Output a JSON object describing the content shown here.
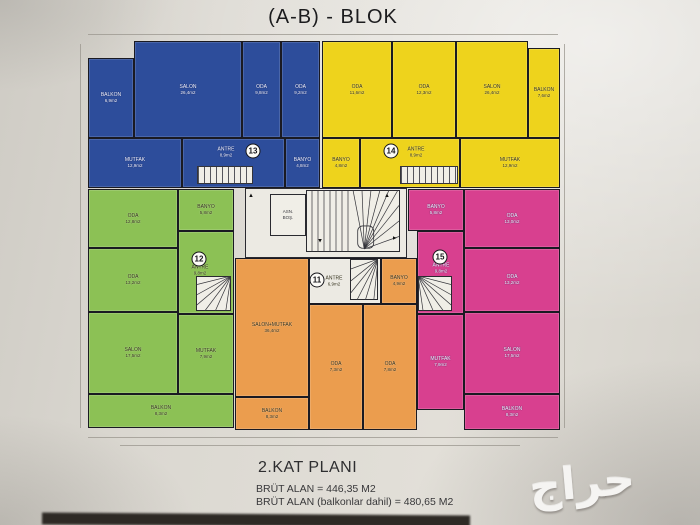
{
  "title": "(A-B) - BLOK",
  "footer": {
    "plan_name": "2.KAT PLANI",
    "line1": "BRÜT ALAN = 446,35 M2",
    "line2": "BRÜT ALAN (balkonlar dahil) = 480,65 M2"
  },
  "watermark": "حراج",
  "plan": {
    "elevator_label_line1": "ASN.",
    "elevator_label_line2": "BOŞ.",
    "colors": {
      "blue": "#2d4d9b",
      "yellow": "#eed31c",
      "green": "#8cc155",
      "orange": "#eb9d4e",
      "pink": "#d8408f",
      "white": "#eceae3"
    },
    "apartments": [
      {
        "number": "13",
        "color": "blue",
        "light": true,
        "circle": {
          "x": 253,
          "y": 151
        },
        "rooms": [
          {
            "key": "balkon",
            "label": "BALKON",
            "area": "6,9m2",
            "x": 88,
            "y": 58,
            "w": 44,
            "h": 78
          },
          {
            "key": "salon",
            "label": "SALON",
            "area": "26,4m2",
            "x": 134,
            "y": 41,
            "w": 106,
            "h": 95
          },
          {
            "key": "oda-1",
            "label": "ODA",
            "area": "9,8m2",
            "x": 242,
            "y": 41,
            "w": 37,
            "h": 95
          },
          {
            "key": "oda-2",
            "label": "ODA",
            "area": "9,2m2",
            "x": 281,
            "y": 41,
            "w": 37,
            "h": 95
          },
          {
            "key": "mutfak",
            "label": "MUTFAK",
            "area": "12,9m2",
            "x": 88,
            "y": 138,
            "w": 92,
            "h": 48
          },
          {
            "key": "antre",
            "label": "ANTRE",
            "area": "8,9m2",
            "x": 182,
            "y": 138,
            "w": 101,
            "h": 48,
            "lx": 226,
            "ly": 152
          },
          {
            "key": "banyo",
            "label": "BANYO",
            "area": "4,8m2",
            "x": 285,
            "y": 138,
            "w": 33,
            "h": 48
          }
        ]
      },
      {
        "number": "14",
        "color": "yellow",
        "light": false,
        "circle": {
          "x": 391,
          "y": 151
        },
        "rooms": [
          {
            "key": "oda-1",
            "label": "ODA",
            "area": "11,6m2",
            "x": 322,
            "y": 41,
            "w": 68,
            "h": 95
          },
          {
            "key": "oda-2",
            "label": "ODA",
            "area": "12,3m2",
            "x": 392,
            "y": 41,
            "w": 62,
            "h": 95
          },
          {
            "key": "salon",
            "label": "SALON",
            "area": "26,4m2",
            "x": 456,
            "y": 41,
            "w": 70,
            "h": 95
          },
          {
            "key": "balkon",
            "label": "BALKON",
            "area": "7,6m2",
            "x": 528,
            "y": 48,
            "w": 30,
            "h": 88
          },
          {
            "key": "banyo",
            "label": "BANYO",
            "area": "4,8m2",
            "x": 322,
            "y": 138,
            "w": 36,
            "h": 48
          },
          {
            "key": "antre",
            "label": "ANTRE",
            "area": "8,9m2",
            "x": 360,
            "y": 138,
            "w": 98,
            "h": 48,
            "lx": 416,
            "ly": 152
          },
          {
            "key": "mutfak",
            "label": "MUTFAK",
            "area": "12,9m2",
            "x": 460,
            "y": 138,
            "w": 98,
            "h": 48
          }
        ]
      },
      {
        "number": "12",
        "color": "green",
        "light": false,
        "circle": {
          "x": 199,
          "y": 259
        },
        "rooms": [
          {
            "key": "oda-1",
            "label": "ODA",
            "area": "12,8m2",
            "x": 88,
            "y": 189,
            "w": 88,
            "h": 57
          },
          {
            "key": "oda-2",
            "label": "ODA",
            "area": "13,2m2",
            "x": 88,
            "y": 248,
            "w": 88,
            "h": 62
          },
          {
            "key": "salon",
            "label": "SALON",
            "area": "17,5m2",
            "x": 88,
            "y": 312,
            "w": 88,
            "h": 80
          },
          {
            "key": "balkon",
            "label": "BALKON",
            "area": "8,3m2",
            "x": 88,
            "y": 394,
            "w": 144,
            "h": 32
          },
          {
            "key": "banyo",
            "label": "BANYO",
            "area": "5,8m2",
            "x": 178,
            "y": 189,
            "w": 54,
            "h": 40
          },
          {
            "key": "antre",
            "label": "ANTRE",
            "area": "9,8m2",
            "x": 178,
            "y": 231,
            "w": 54,
            "h": 81,
            "lx": 200,
            "ly": 270
          },
          {
            "key": "mutfak",
            "label": "MUTFAK",
            "area": "7,9m2",
            "x": 178,
            "y": 314,
            "w": 54,
            "h": 78
          }
        ]
      },
      {
        "number": "11",
        "color": "orange",
        "light": false,
        "circle": {
          "x": 317,
          "y": 280
        },
        "rooms": [
          {
            "key": "salon-mutfak",
            "label": "SALON+MUTFAK",
            "area": "36,4m2",
            "x": 235,
            "y": 258,
            "w": 72,
            "h": 137
          },
          {
            "key": "balkon",
            "label": "BALKON",
            "area": "8,3m2",
            "x": 235,
            "y": 397,
            "w": 72,
            "h": 31
          },
          {
            "key": "antre",
            "label": "ANTRE",
            "area": "6,9m2",
            "x": 309,
            "y": 258,
            "w": 70,
            "h": 44,
            "white": true,
            "lx": 334,
            "ly": 281
          },
          {
            "key": "banyo",
            "label": "BANYO",
            "area": "4,9m2",
            "x": 381,
            "y": 258,
            "w": 34,
            "h": 44
          },
          {
            "key": "oda-1",
            "label": "ODA",
            "area": "7,3m2",
            "x": 309,
            "y": 304,
            "w": 52,
            "h": 124
          },
          {
            "key": "oda-2",
            "label": "ODA",
            "area": "7,8m2",
            "x": 363,
            "y": 304,
            "w": 52,
            "h": 124
          }
        ]
      },
      {
        "number": "15",
        "color": "pink",
        "light": true,
        "circle": {
          "x": 440,
          "y": 257
        },
        "rooms": [
          {
            "key": "banyo",
            "label": "BANYO",
            "area": "5,8m2",
            "x": 408,
            "y": 189,
            "w": 54,
            "h": 40
          },
          {
            "key": "antre",
            "label": "ANTRE",
            "area": "9,8m2",
            "x": 417,
            "y": 231,
            "w": 45,
            "h": 81,
            "lx": 441,
            "ly": 268
          },
          {
            "key": "mutfak",
            "label": "MUTFAK",
            "area": "7,9m2",
            "x": 417,
            "y": 314,
            "w": 45,
            "h": 94
          },
          {
            "key": "oda-1",
            "label": "ODA",
            "area": "13,0m2",
            "x": 464,
            "y": 189,
            "w": 94,
            "h": 57
          },
          {
            "key": "oda-2",
            "label": "ODA",
            "area": "13,2m2",
            "x": 464,
            "y": 248,
            "w": 94,
            "h": 62
          },
          {
            "key": "salon",
            "label": "SALON",
            "area": "17,5m2",
            "x": 464,
            "y": 312,
            "w": 94,
            "h": 80
          },
          {
            "key": "balkon",
            "label": "BALKON",
            "area": "8,3m2",
            "x": 464,
            "y": 394,
            "w": 94,
            "h": 34
          }
        ]
      }
    ],
    "stairs": [
      {
        "kind": "straight",
        "x": 197,
        "y": 166,
        "w": 54,
        "h": 16
      },
      {
        "kind": "straight",
        "x": 400,
        "y": 166,
        "w": 56,
        "h": 16
      },
      {
        "kind": "fan",
        "corner": "tr",
        "x": 196,
        "y": 276,
        "w": 35,
        "h": 35
      },
      {
        "kind": "fan",
        "corner": "tl",
        "x": 418,
        "y": 276,
        "w": 34,
        "h": 35
      },
      {
        "kind": "fan",
        "corner": "tr",
        "x": 350,
        "y": 259,
        "w": 28,
        "h": 41
      },
      {
        "kind": "main",
        "x": 306,
        "y": 190,
        "w": 94,
        "h": 62
      }
    ],
    "arrows": [
      {
        "x": 251,
        "y": 196,
        "r": 0
      },
      {
        "x": 387,
        "y": 196,
        "r": 0
      },
      {
        "x": 320,
        "y": 240,
        "r": 180
      },
      {
        "x": 394,
        "y": 238,
        "r": 90
      }
    ]
  }
}
